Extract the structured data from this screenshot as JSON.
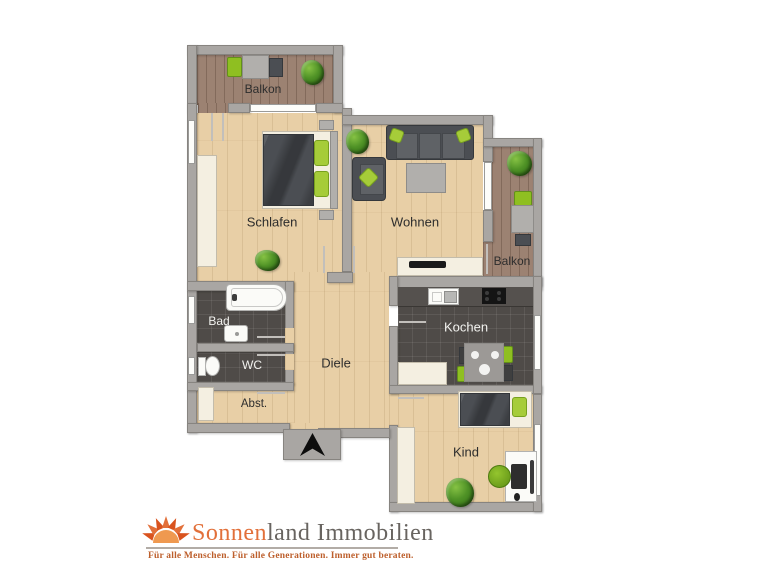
{
  "plan": {
    "labels": {
      "balkon_top": "Balkon",
      "schlafen": "Schlafen",
      "wohnen": "Wohnen",
      "balkon_right": "Balkon",
      "bad": "Bad",
      "wc": "WC",
      "abst": "Abst.",
      "diele": "Diele",
      "kochen": "Kochen",
      "kind": "Kind"
    },
    "colors": {
      "wall": "#a9a6a3",
      "floor_wood_light": "#e8cfa6",
      "floor_wood_dark": "#9c8272",
      "floor_tile_dark": "#4f4b48",
      "furniture_dark": "#4b4e53",
      "furniture_gray": "#b1afac",
      "furniture_cream": "#f4efe1",
      "accent_green": "#8fbf21",
      "label_dark": "#2d2d2d",
      "label_light": "#f2f2ef"
    }
  },
  "footer": {
    "brand_orange": "Sonnen",
    "brand_rest": "land Immobilien",
    "tagline": "Für alle Menschen. Für alle Generationen. Immer gut beraten.",
    "colors": {
      "orange": "#e2703a",
      "gray": "#686460",
      "tagline_brown": "#bd5f2c",
      "divider": "#b2aca6"
    }
  }
}
